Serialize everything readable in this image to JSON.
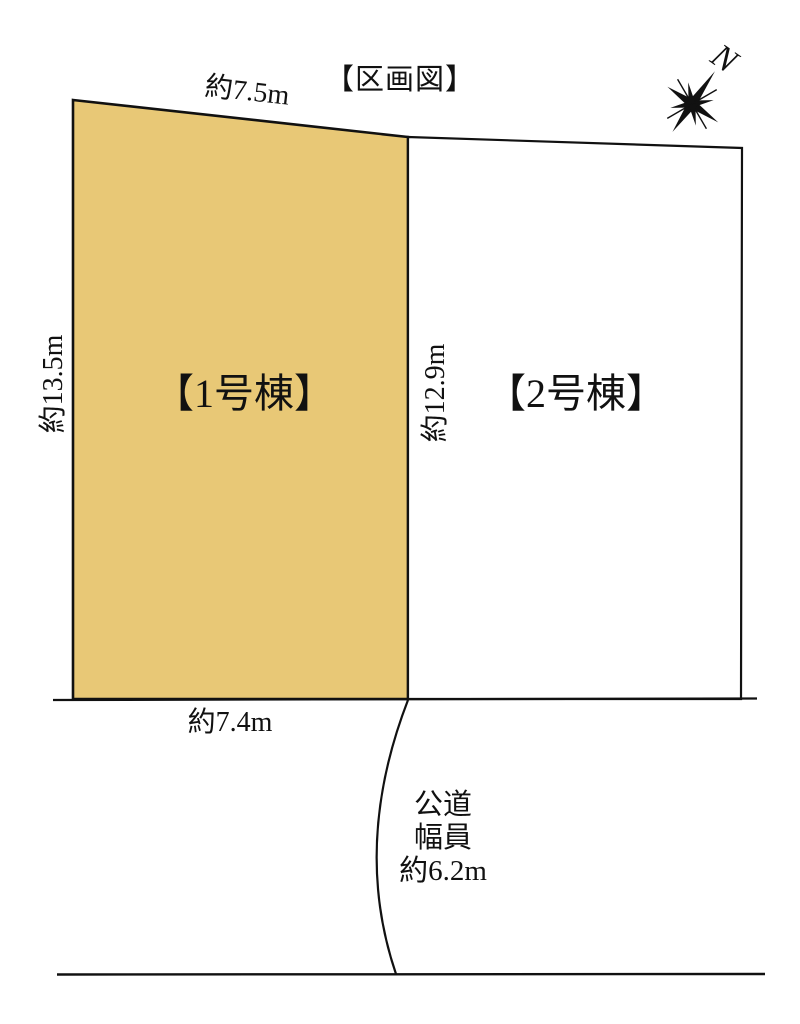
{
  "title": "【区画図】",
  "compass": {
    "north_label": "N"
  },
  "lots": [
    {
      "id": "1",
      "label": "【1号棟】",
      "fill": "#e8c876"
    },
    {
      "id": "2",
      "label": "【2号棟】",
      "fill": "#ffffff"
    }
  ],
  "dimensions": {
    "lot1_top": "約7.5m",
    "lot1_left": "約13.5m",
    "lot2_left": "約12.9m",
    "lot1_bottom": "約7.4m"
  },
  "road": {
    "name": "公道",
    "width_label": "幅員",
    "width_value": "約6.2m"
  },
  "colors": {
    "line": "#111111",
    "background": "#ffffff"
  }
}
